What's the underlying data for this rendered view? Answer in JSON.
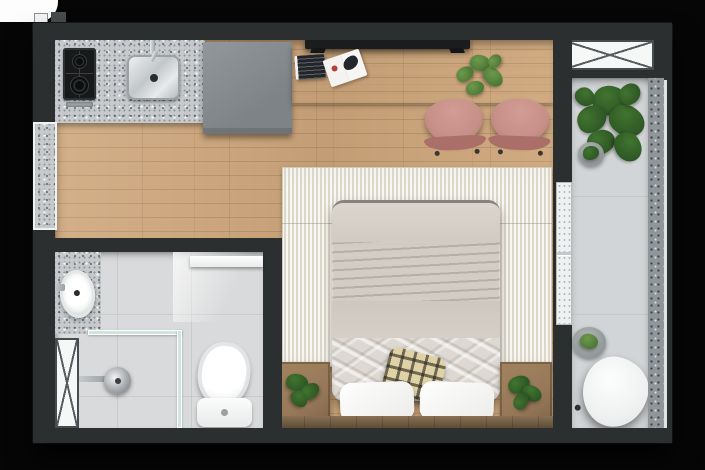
{
  "image_type": "architectural-floor-plan-top-view-render",
  "subject": "studio apartment floor plan",
  "rooms": {
    "kitchen": "kitchen",
    "work_area": "work area",
    "sleeping_area": "sleeping area",
    "bathroom": "bathroom",
    "balcony": "balcony"
  },
  "furniture": {
    "kitchen": [
      "granite-counter",
      "two-burner-cooktop",
      "stainless-sink",
      "wall-faucet",
      "tall-gray-cabinet"
    ],
    "work_area": [
      "wood-desk",
      "wall-mounted-tv",
      "magazine-stack",
      "open-magazine",
      "desk-plant",
      "pink-chair-left",
      "pink-chair-right"
    ],
    "sleeping_area": [
      "striped-rug",
      "double-bed",
      "brown-throw-blanket",
      "rumpled-sheet",
      "white-pillow-left",
      "white-pillow-right",
      "plaid-cushion",
      "wood-headboard",
      "planter-nightstand-left",
      "planter-nightstand-right"
    ],
    "bathroom": [
      "granite-vanity",
      "vessel-sink",
      "wall-faucet",
      "white-sliding-door",
      "shower-glass-partition",
      "shower-head",
      "toilet",
      "utility-shaft-symbol"
    ],
    "balcony": [
      "utility-box-symbol",
      "large-plant",
      "small-potted-plant",
      "round-planter",
      "white-side-table",
      "glass-sliding-door",
      "speckled-railing"
    ],
    "exterior": [
      "left-wall-window"
    ]
  },
  "colors": {
    "bg": "#060606",
    "wall": "#2b2f30",
    "wood": "#cfa77c",
    "desk": "#e2ccab",
    "granite": "#c6cacd",
    "cabinet": "#8a8f93",
    "chair": "#c79089",
    "rug": "#ece9dd",
    "rug_stripe": "#dcd8c9",
    "duvet": "#d2ccc4",
    "throw": "#9c6b3e",
    "pillow": "#ececea",
    "plaid": "#dfd2a6",
    "headboard": "#7d6547",
    "nightstand": "#97795a",
    "bath_floor": "#d9dadb",
    "balcony_floor": "#d2d5d7",
    "railing": "#8f9598",
    "plant": "#41742f",
    "plant_dark": "#2c5424",
    "glass": "#cfe6de",
    "tv": "#1a1c1d"
  }
}
